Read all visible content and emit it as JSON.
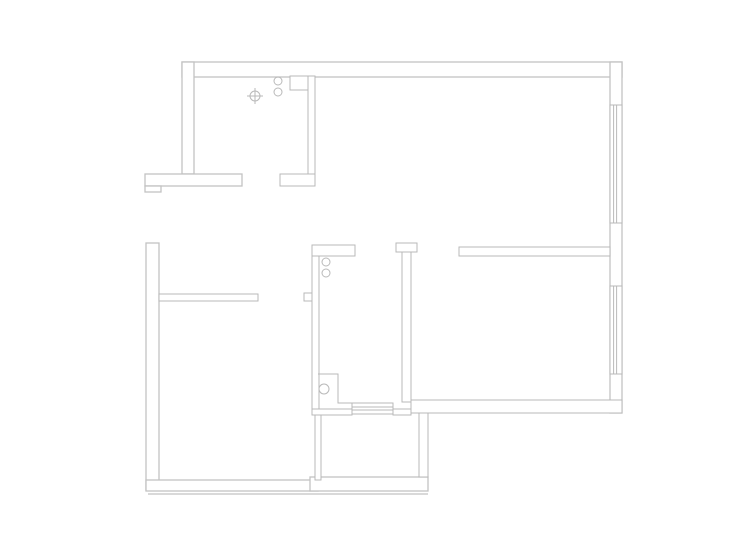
{
  "canvas": {
    "width": 740,
    "height": 555,
    "background": "#ffffff",
    "line_color": "#b9b9b9",
    "exterior_line_color": "#c2c2c2",
    "wall_fill": "#ffffff"
  },
  "floorplan": {
    "walls": [
      {
        "name": "exterior-top-wall",
        "x": 182,
        "y": 62,
        "w": 440,
        "h": 15,
        "ext": true
      },
      {
        "name": "exterior-right-wall",
        "x": 610,
        "y": 62,
        "w": 12,
        "h": 351,
        "ext": true
      },
      {
        "name": "exterior-kitchen-left-wall",
        "x": 182,
        "y": 62,
        "w": 12,
        "h": 112,
        "ext": true
      },
      {
        "name": "entrance-top-wall",
        "x": 145,
        "y": 174,
        "w": 97,
        "h": 12,
        "ext": true
      },
      {
        "name": "entrance-step",
        "x": 145,
        "y": 186,
        "w": 16,
        "h": 6,
        "ext": true
      },
      {
        "name": "exterior-lower-left-wall",
        "x": 146,
        "y": 243,
        "w": 13,
        "h": 247,
        "ext": true
      },
      {
        "name": "exterior-bottom-wall-left",
        "x": 146,
        "y": 480,
        "w": 172,
        "h": 11,
        "ext": true
      },
      {
        "name": "exterior-bottom-wall-balcony",
        "x": 310,
        "y": 477,
        "w": 118,
        "h": 14,
        "ext": true
      },
      {
        "name": "kitchen-right-wall",
        "x": 308,
        "y": 76,
        "w": 7,
        "h": 110
      },
      {
        "name": "kitchen-duct",
        "x": 290,
        "y": 76,
        "w": 18,
        "h": 14
      },
      {
        "name": "kitchen-foot-wall",
        "x": 280,
        "y": 174,
        "w": 35,
        "h": 12
      },
      {
        "name": "bedroom1-top-wall",
        "x": 159,
        "y": 294,
        "w": 99,
        "h": 7
      },
      {
        "name": "bathroom-left-wall",
        "x": 312,
        "y": 245,
        "w": 7,
        "h": 170
      },
      {
        "name": "bathroom-left-notch",
        "x": 304,
        "y": 293,
        "w": 8,
        "h": 8
      },
      {
        "name": "bathroom-top-wall",
        "x": 312,
        "y": 245,
        "w": 43,
        "h": 11
      },
      {
        "name": "hall-pillar-cap",
        "x": 396,
        "y": 243,
        "w": 21,
        "h": 9
      },
      {
        "name": "hall-pillar-stem",
        "x": 402,
        "y": 252,
        "w": 9,
        "h": 150
      },
      {
        "name": "bedroom2-top-wall",
        "x": 459,
        "y": 247,
        "w": 151,
        "h": 9
      },
      {
        "name": "bedroom2-bottom-wall",
        "x": 411,
        "y": 400,
        "w": 211,
        "h": 13
      },
      {
        "name": "balcony-left-wall",
        "x": 315,
        "y": 415,
        "w": 6,
        "h": 65
      },
      {
        "name": "balcony-right-wall",
        "x": 419,
        "y": 413,
        "w": 9,
        "h": 64
      },
      {
        "name": "bathroom-bottom-wall-left",
        "x": 312,
        "y": 409,
        "w": 40,
        "h": 6
      },
      {
        "name": "bathroom-bottom-wall-right",
        "x": 393,
        "y": 409,
        "w": 18,
        "h": 6
      }
    ],
    "polylines": [
      {
        "name": "bathroom-step-outline",
        "points": [
          [
            318,
            374
          ],
          [
            338,
            374
          ],
          [
            338,
            403
          ],
          [
            352,
            403
          ]
        ]
      }
    ],
    "lines": [
      {
        "name": "bottom-outer-edge-line",
        "x1": 148,
        "y1": 494,
        "x2": 428,
        "y2": 494
      }
    ],
    "windows": [
      {
        "name": "window-living-room",
        "x": 610,
        "y": 105,
        "w": 12,
        "h": 118
      },
      {
        "name": "window-bedroom2",
        "x": 610,
        "y": 286,
        "w": 12,
        "h": 88
      }
    ],
    "threshold": {
      "name": "balcony-door-threshold",
      "x": 352,
      "y": 403,
      "w": 41,
      "h": 11,
      "inner_ys": [
        407,
        410
      ]
    },
    "circles": [
      {
        "name": "kitchen-pipe-upper",
        "cx": 278,
        "cy": 81,
        "r": 4
      },
      {
        "name": "kitchen-pipe-lower",
        "cx": 278,
        "cy": 92,
        "r": 4
      },
      {
        "name": "bathroom-pipe-upper",
        "cx": 326,
        "cy": 262,
        "r": 4
      },
      {
        "name": "bathroom-pipe-lower",
        "cx": 326,
        "cy": 273,
        "r": 4
      },
      {
        "name": "bathroom-floor-drain",
        "cx": 324,
        "cy": 389,
        "r": 5
      }
    ],
    "cross_symbol": {
      "name": "kitchen-drain-symbol",
      "cx": 255,
      "cy": 96,
      "r": 5,
      "arm": 8
    }
  }
}
